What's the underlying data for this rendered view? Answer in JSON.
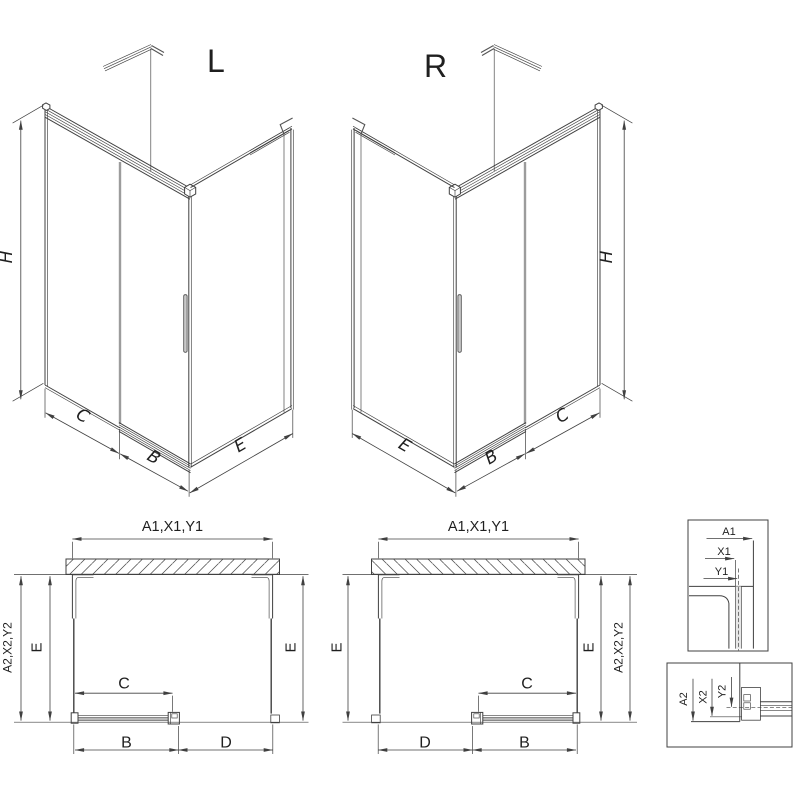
{
  "views": {
    "iso_left": {
      "title": "L",
      "height": "H",
      "panel": "C",
      "door": "B",
      "side": "E"
    },
    "iso_right": {
      "title": "R",
      "height": "H",
      "panel": "C",
      "door": "B",
      "side": "E"
    },
    "plan_left": {
      "width_top": "A1,X1,Y1",
      "depth_outer": "A2,X2,Y2",
      "depth_left": "E",
      "depth_right": "E",
      "door_glass": "C",
      "rail": "B",
      "opening": "D"
    },
    "plan_right": {
      "width_top": "A1,X1,Y1",
      "depth_outer": "A2,X2,Y2",
      "depth_left": "E",
      "depth_right": "E",
      "door_glass": "C",
      "rail": "B",
      "opening": "D"
    },
    "detail_wall": {
      "a": "A1",
      "x": "X1",
      "y": "Y1"
    },
    "detail_floor": {
      "a": "A2",
      "x": "X2",
      "y": "Y2"
    }
  },
  "colors": {
    "line": "#404040",
    "door_gray": "#9c9c9c",
    "glass_fill": "#e7e7e7",
    "background": "#ffffff"
  }
}
